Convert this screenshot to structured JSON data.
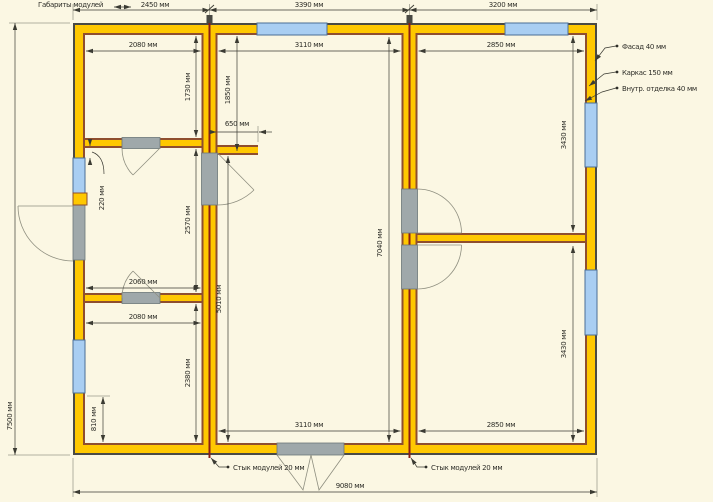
{
  "drawing": {
    "legend": "Габариты модулей",
    "top": [
      "2450 мм",
      "3390 мм",
      "3200 мм"
    ],
    "left_total": "7500 мм",
    "bottom_total": "9080 мм",
    "lm": {
      "w1": "2080 мм",
      "h1": "1730 мм",
      "off": "220 мм",
      "h2": "2570 мм",
      "w2": "2060 мм",
      "w3": "2080 мм",
      "h3": "2380 мм",
      "sill": "810 мм"
    },
    "cm": {
      "wt": "3110 мм",
      "hall": "1850 мм",
      "stub": "650 мм",
      "inner": "5010 мм",
      "full": "7040 мм",
      "wb": "3110 мм"
    },
    "rm": {
      "wt": "2850 мм",
      "ht": "3430 мм",
      "hb": "3430 мм",
      "wb": "2850 мм"
    },
    "callouts": {
      "facade": "Фасад 40 мм",
      "frame": "Каркас 150 мм",
      "finish": "Внутр. отделка 40 мм",
      "joint_l": "Стык модулей 20 мм",
      "joint_r": "Стык модулей 20 мм"
    },
    "colors": {
      "paper": "#FBF7E3",
      "wall_frame_yellow": "#FFC800",
      "facade_outline": "#4A4A44",
      "inner_finish_brown": "#8F4E2E",
      "window_blue": "#A9CEF2",
      "opening_gray": "#9FA8AA",
      "module_joint_red": "#8B1D14"
    }
  }
}
